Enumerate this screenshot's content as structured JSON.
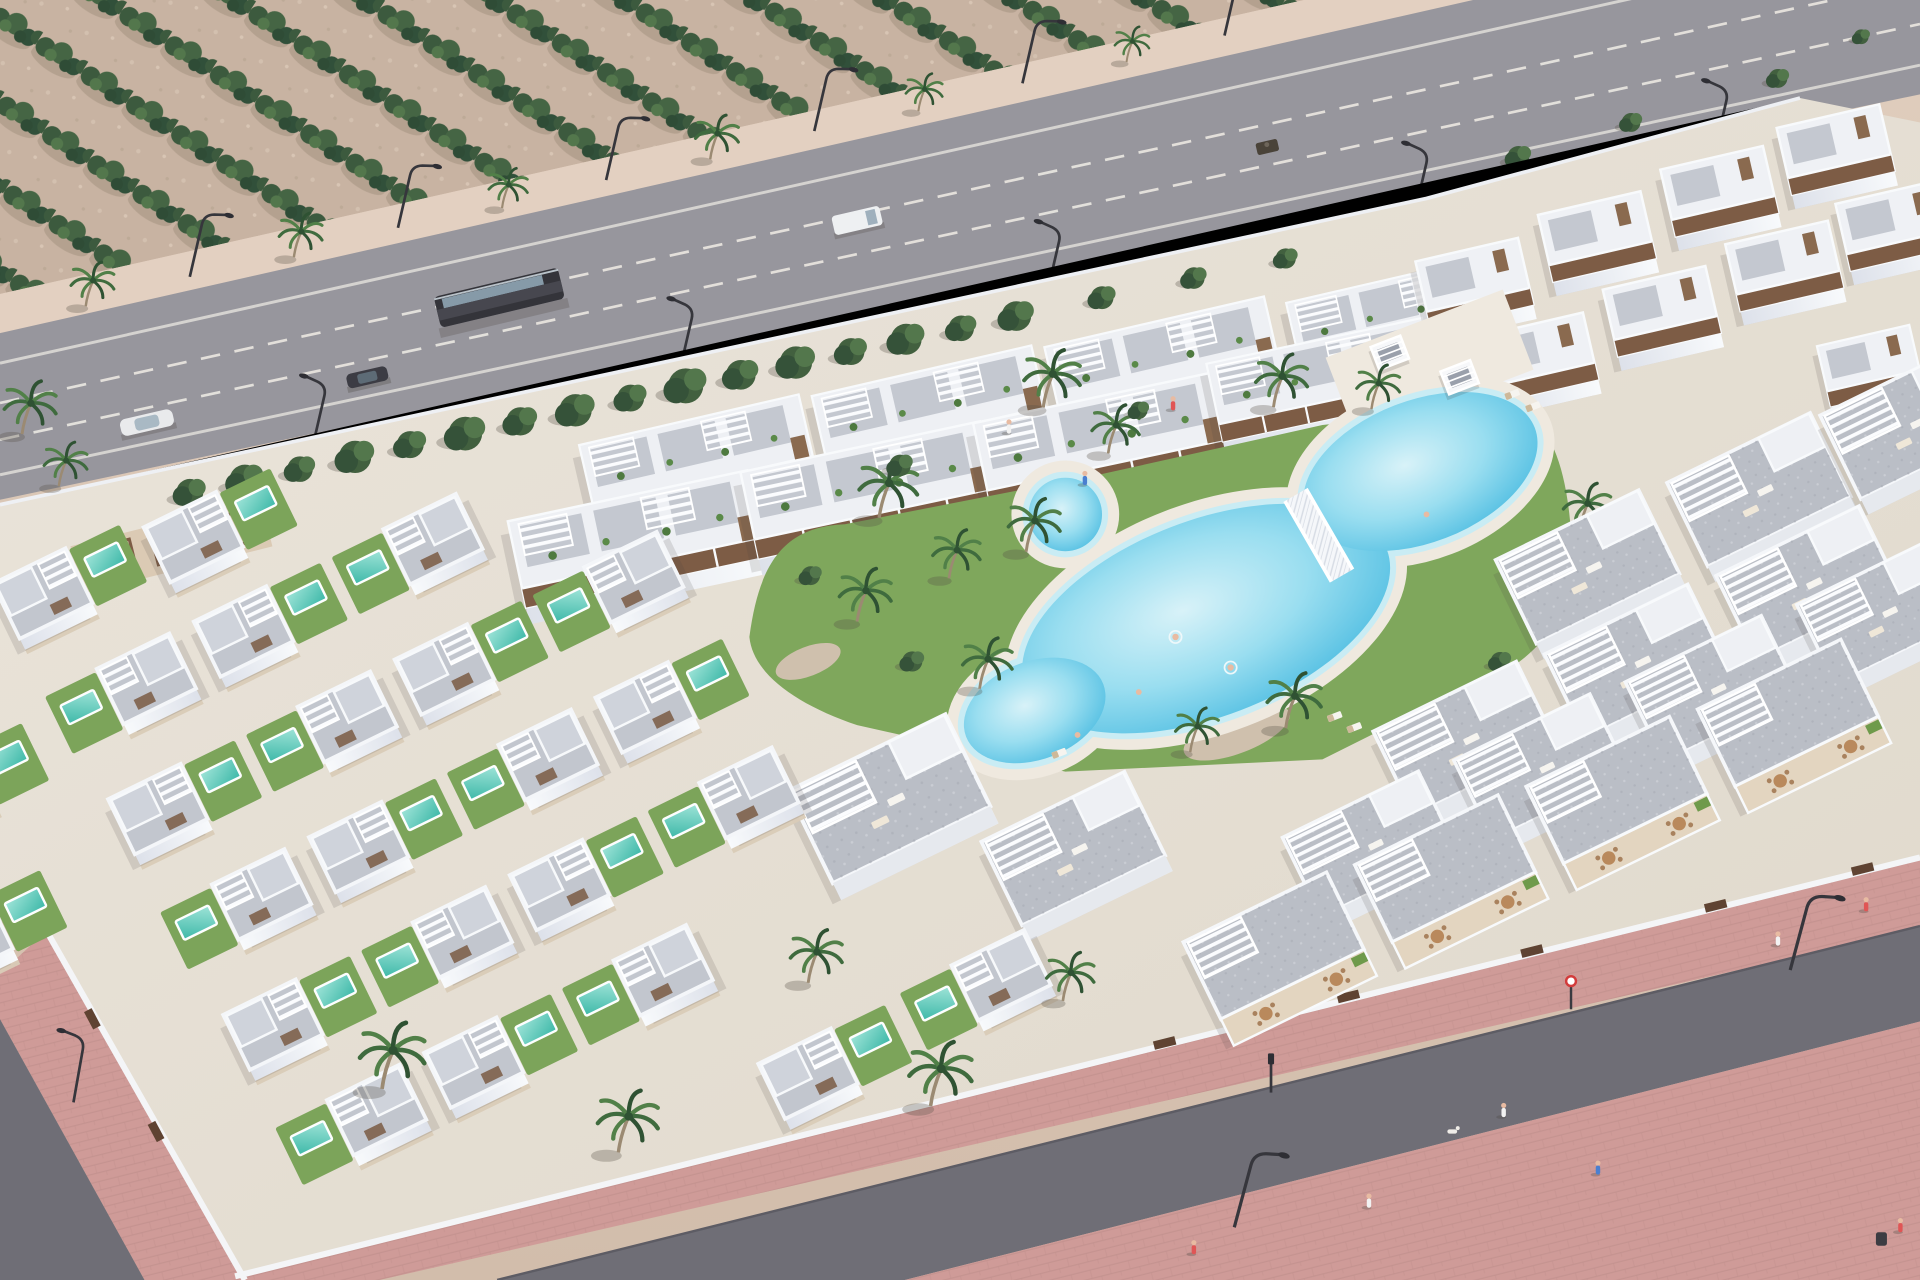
{
  "meta": {
    "description": "Aerial 3D architectural render of a coastal residential development with white villas, terraced apartments, a communal lagoon pool, an olive grove and a highway",
    "view": "high-angle aerial, daytime"
  },
  "palette": {
    "sand": "#d7c2b1",
    "orchard_ground": "#c8b3a2",
    "tree_dark": "#35523a",
    "tree_mid": "#47684a",
    "tree_light": "#53774c",
    "asphalt_highway": "#97969d",
    "asphalt_street": "#6f6e76",
    "lane_marking": "#f0ede6",
    "building_white": "#f2f4f8",
    "building_shade": "#d9dde6",
    "roof_gray": "#bfc3cb",
    "wood_brown": "#7d5c45",
    "lawn_green": "#7ca45a",
    "private_pool": "#3db8a8",
    "lagoon_pool": "#57c0e0",
    "pool_deck": "#efe9df",
    "pink_walkway": "#cf9b98",
    "path_beige": "#d9cbb7"
  },
  "scene": {
    "labels": {
      "scene": "Aerial render of residential complex",
      "orchard": "Olive grove with diagonal tree rows",
      "highway": "Dual carriageway with traffic",
      "bus": "Dark city bus",
      "van": "White van",
      "white_car": "White car",
      "dark_car": "Dark car",
      "quad": "Quad bike",
      "complex": "Walled residential complex",
      "pool": "Communal lagoon pool",
      "bridge": "White lattice footbridge",
      "cabanas": "White pool cabanas",
      "villas": "Detached villas with private pools",
      "apartments": "Terraced apartment blocks with roof pergolas",
      "promenade": "Pink pedestrian promenade",
      "people": "Pedestrians and swimmers"
    },
    "counts": {
      "villas": 24,
      "private_pools": 24,
      "apartment_blocks": 27,
      "cabanas": 2,
      "footbridges": 1,
      "vehicles": 5,
      "street_lamps": 14,
      "people": 16,
      "palm_trees": 25,
      "dogs": 1
    }
  }
}
